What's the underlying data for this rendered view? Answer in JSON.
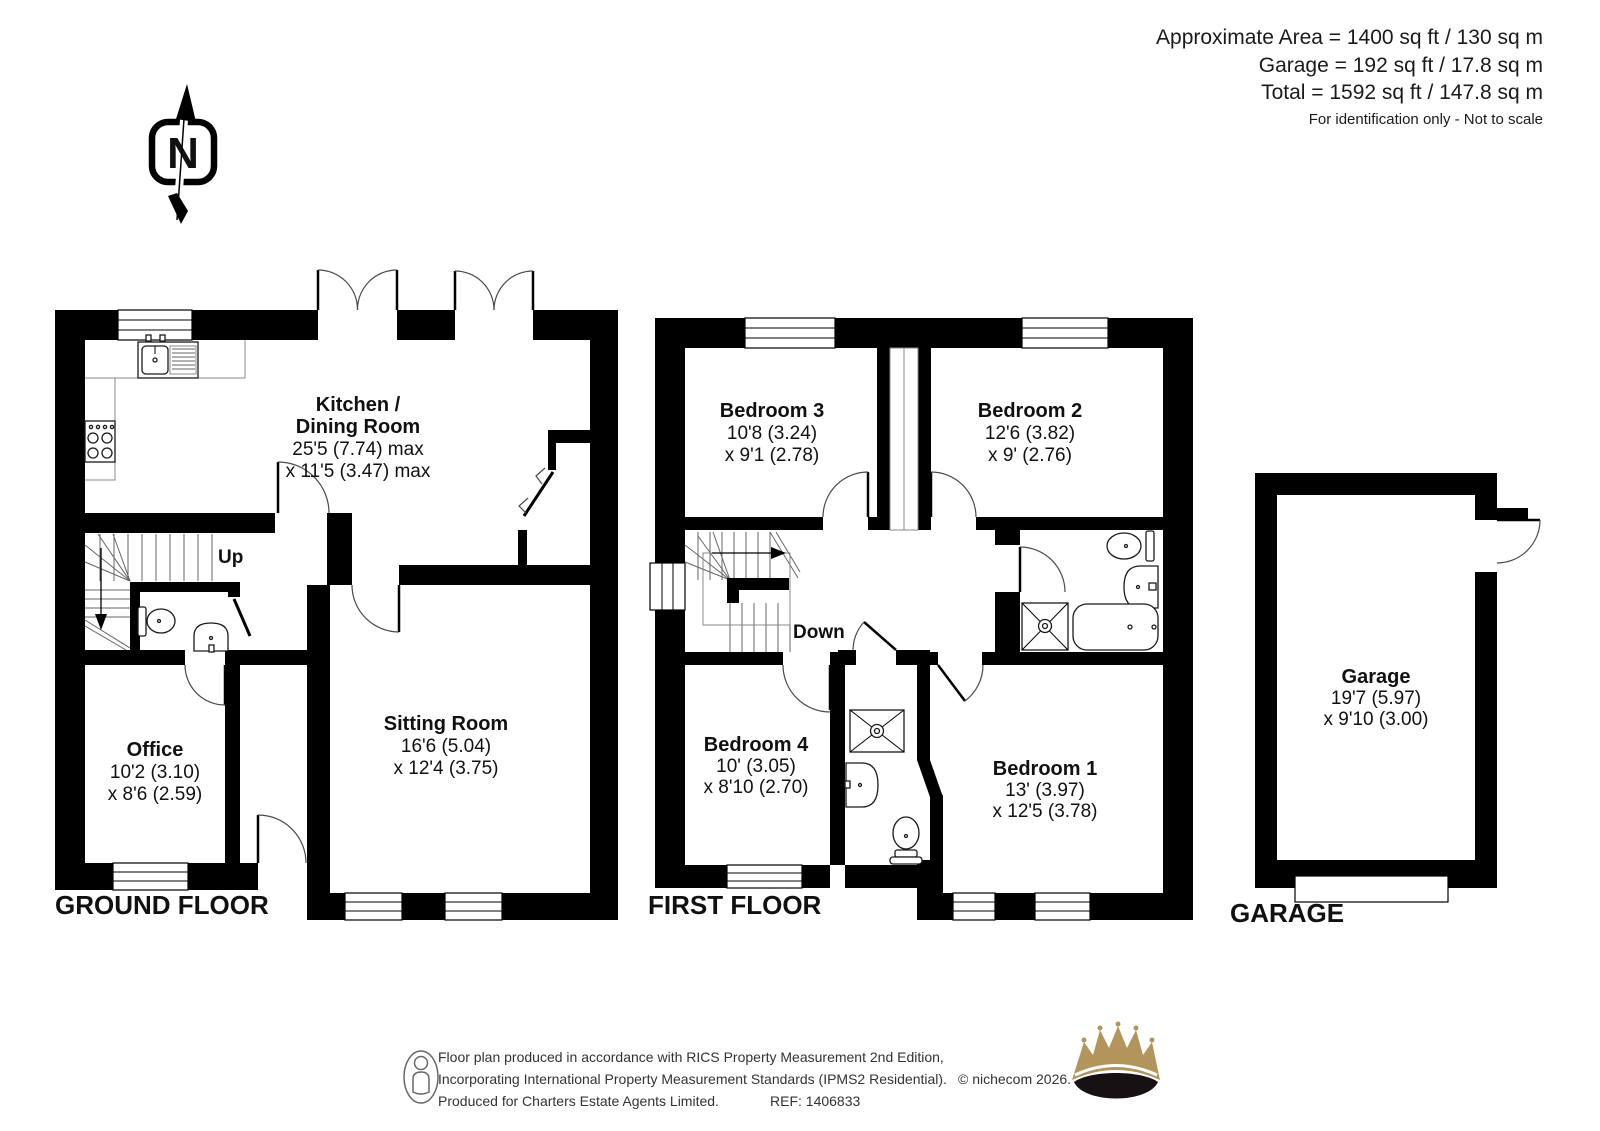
{
  "header": {
    "area_line": "Approximate Area = 1400 sq ft / 130 sq m",
    "garage_line": "Garage  = 192 sq ft / 17.8 sq m",
    "total_line": "Total = 1592 sq ft / 147.8 sq m",
    "note": "For identification only - Not to scale"
  },
  "compass": {
    "north_label": "N"
  },
  "ground_floor": {
    "label": "GROUND FLOOR",
    "kitchen_name1": "Kitchen /",
    "kitchen_name2": "Dining Room",
    "kitchen_dim1": "25'5 (7.74) max",
    "kitchen_dim2": "x 11'5 (3.47) max",
    "sitting_name": "Sitting Room",
    "sitting_dim1": "16'6 (5.04)",
    "sitting_dim2": "x 12'4 (3.75)",
    "office_name": "Office",
    "office_dim1": "10'2 (3.10)",
    "office_dim2": "x 8'6 (2.59)",
    "stairs_label": "Up"
  },
  "first_floor": {
    "label": "FIRST FLOOR",
    "bedroom3_name": "Bedroom 3",
    "bedroom3_dim1": "10'8 (3.24)",
    "bedroom3_dim2": "x 9'1 (2.78)",
    "bedroom2_name": "Bedroom 2",
    "bedroom2_dim1": "12'6 (3.82)",
    "bedroom2_dim2": "x 9' (2.76)",
    "bedroom4_name": "Bedroom 4",
    "bedroom4_dim1": "10' (3.05)",
    "bedroom4_dim2": "x 8'10 (2.70)",
    "bedroom1_name": "Bedroom 1",
    "bedroom1_dim1": "13' (3.97)",
    "bedroom1_dim2": "x 12'5 (3.78)",
    "stairs_label": "Down"
  },
  "garage": {
    "label": "GARAGE",
    "name": "Garage",
    "dim1": "19'7 (5.97)",
    "dim2": "x 9'10 (3.00)"
  },
  "footer": {
    "line1": "Floor plan produced in accordance with RICS Property Measurement 2nd Edition,",
    "line2": "Incorporating International Property Measurement Standards (IPMS2 Residential).",
    "line3": "Produced for Charters Estate Agents Limited.",
    "ref": "REF: 1406833",
    "copyright": "© nichecom 2026."
  },
  "colors": {
    "wall": "#000000",
    "crown_gold": "#b3955c",
    "crown_dark": "#181114"
  }
}
